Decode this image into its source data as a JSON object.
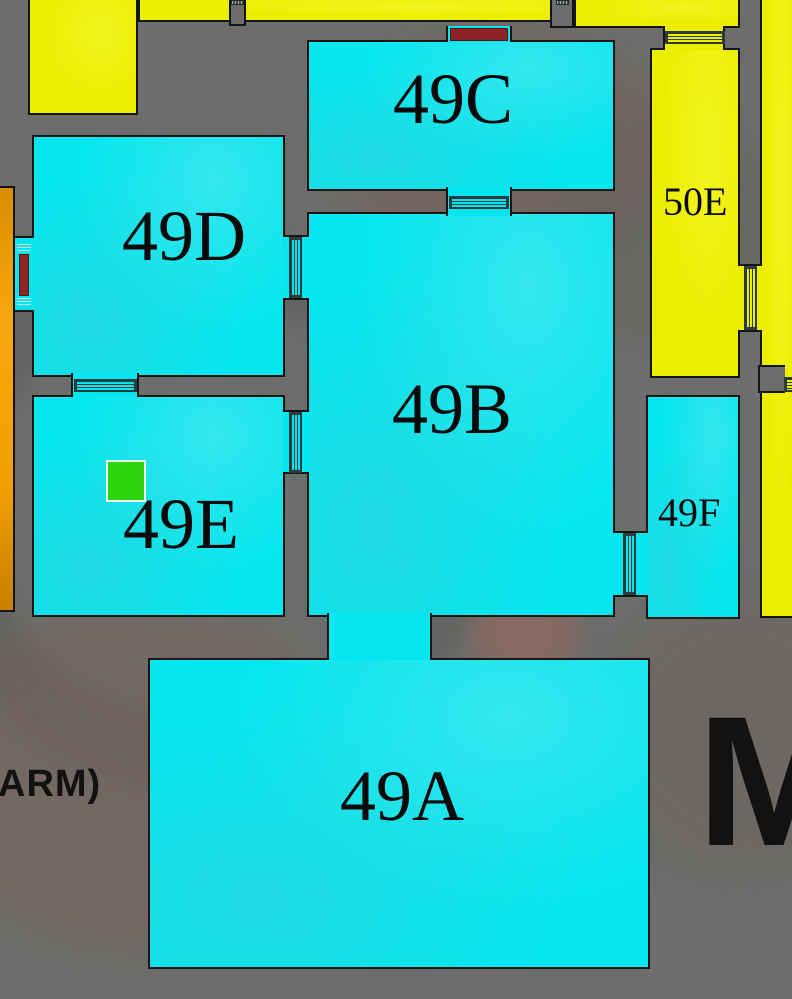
{
  "floorplan": {
    "title": "museum-gallery-floorplan",
    "rooms": [
      {
        "id": "49A",
        "label": "49A",
        "fill": "cyan"
      },
      {
        "id": "49B",
        "label": "49B",
        "fill": "cyan"
      },
      {
        "id": "49C",
        "label": "49C",
        "fill": "cyan"
      },
      {
        "id": "49D",
        "label": "49D",
        "fill": "cyan"
      },
      {
        "id": "49E",
        "label": "49E",
        "fill": "cyan"
      },
      {
        "id": "49F",
        "label": "49F",
        "fill": "cyan"
      },
      {
        "id": "50E",
        "label": "50E",
        "fill": "yellow"
      }
    ],
    "marker": {
      "room": "49E",
      "shape": "square",
      "color": "#2bd60f"
    },
    "overlay_texts": {
      "left_partial": "ARM)",
      "right_partial": "M"
    },
    "colors": {
      "background_gray": "#6b6e6b",
      "room_cyan": "#04e7f0",
      "room_yellow": "#ecee00",
      "corridor_orange": "#f2a004",
      "closed_door_red": "#8e2326",
      "marker_green": "#2bd60f",
      "outline_black": "#141414"
    }
  }
}
